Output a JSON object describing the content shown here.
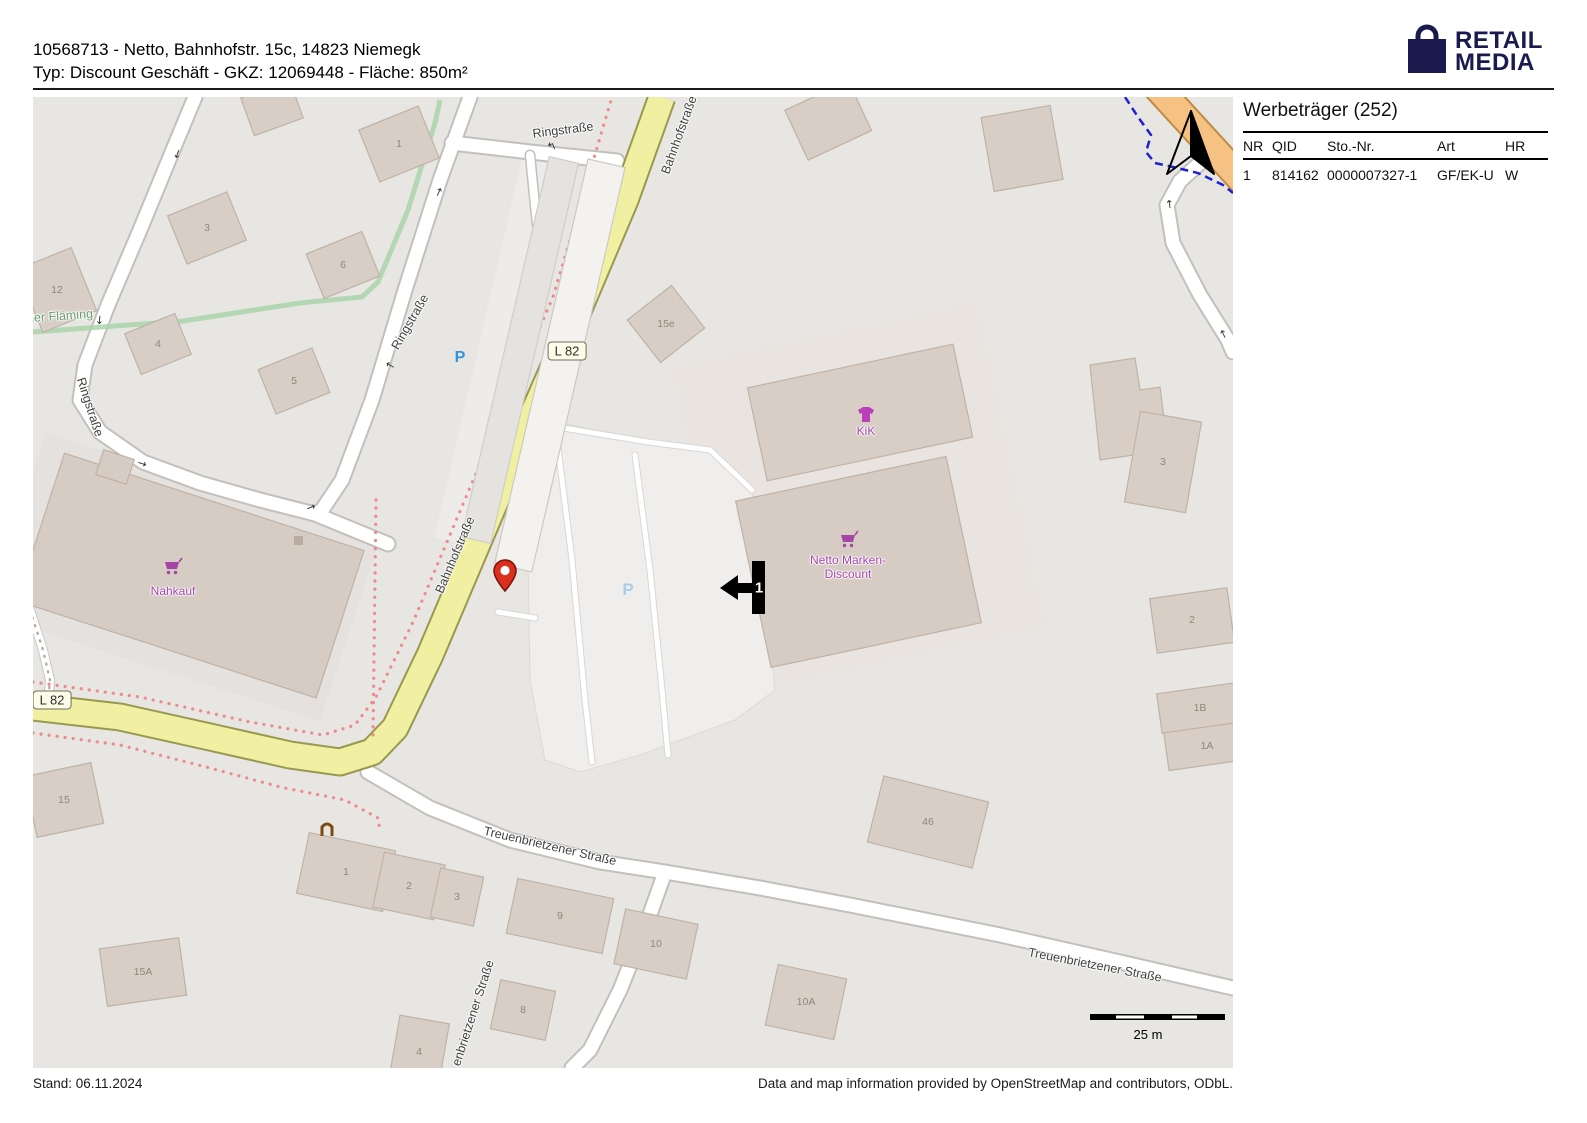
{
  "header": {
    "line1": "10568713 - Netto, Bahnhofstr. 15c, 14823 Niemegk",
    "line2": "Typ: Discount Geschäft - GKZ: 12069448 - Fläche: 850m²"
  },
  "logo": {
    "line1": "RETAIL",
    "line2": "MEDIA",
    "color": "#1a1a4f"
  },
  "sidebar": {
    "title": "Werbeträger (252)",
    "columns": [
      "NR",
      "QID",
      "Sto.-Nr.",
      "Art",
      "HR"
    ],
    "rows": [
      [
        "1",
        "814162",
        "0000007327-1",
        "GF/EK-U",
        "W"
      ]
    ]
  },
  "footer": {
    "left": "Stand: 06.11.2024",
    "right": "Data and map information provided by OpenStreetMap and contributors, ODbL."
  },
  "map": {
    "street_labels": [
      "Ringstraße",
      "Bahnhofstraße",
      "Ringstraße",
      "Ringstraße",
      "Bahnhofstraße",
      "Treuenbrietzener Straße",
      "Treuenbrietzener Straße",
      "enbrietzener Straße",
      "her Fläming"
    ],
    "shop_labels": {
      "nahkauf": "Nahkauf",
      "kik": "KiK",
      "netto_line1": "Netto Marken-",
      "netto_line2": "Discount"
    },
    "route_ref": "L 82",
    "parking_symbol": "P",
    "scale_label": "25 m",
    "werbetraeger_marker_label": "1",
    "building_numbers": [
      "12",
      "3",
      "6",
      "1",
      "4",
      "5",
      "15e",
      "3",
      "2",
      "1B",
      "1A",
      "46",
      "10A",
      "10",
      "9",
      "8",
      "4",
      "1",
      "2",
      "3",
      "15",
      "15A"
    ],
    "colors": {
      "road_yellow": "#f1f0a2",
      "road_orange": "#f5c283",
      "building": "#d8cec6",
      "shop_purple": "#a545a8",
      "marker_red": "#dd2f1e",
      "boundary_blue": "#2020d0",
      "route_dotted_red": "#ee8a8a",
      "trail_green": "#aad3aa"
    }
  }
}
